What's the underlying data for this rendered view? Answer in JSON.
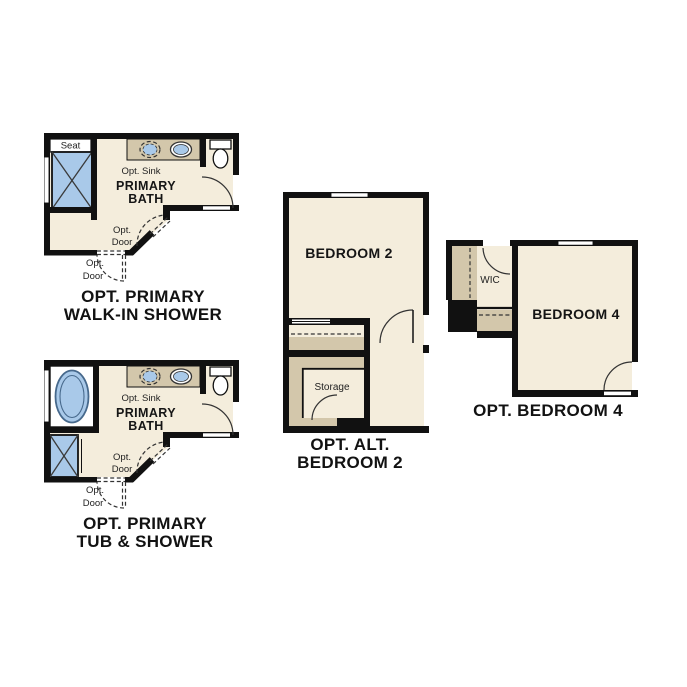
{
  "background": "#ffffff",
  "colors": {
    "wall": "#111111",
    "floor": "#f4eddc",
    "cabinet_tan": "#d3c7ab",
    "fixture_blue": "#a9c9e9",
    "text": "#121212"
  },
  "plans": {
    "walk_in_shower": {
      "caption": [
        "OPT. PRIMARY",
        "WALK-IN SHOWER"
      ],
      "room_label": [
        "PRIMARY",
        "BATH"
      ],
      "seat_label": "Seat",
      "opt_sink_label": "Opt. Sink",
      "opt_door_inner_label": [
        "Opt.",
        "Door"
      ],
      "opt_door_outer_label": [
        "Opt.",
        "Door"
      ]
    },
    "tub_shower": {
      "caption": [
        "OPT. PRIMARY",
        "TUB & SHOWER"
      ],
      "room_label": [
        "PRIMARY",
        "BATH"
      ],
      "opt_sink_label": "Opt. Sink",
      "opt_door_inner_label": [
        "Opt.",
        "Door"
      ],
      "opt_door_outer_label": [
        "Opt.",
        "Door"
      ]
    },
    "alt_bedroom2": {
      "caption": [
        "OPT. ALT.",
        "BEDROOM 2"
      ],
      "room_label": "BEDROOM 2",
      "storage_label": "Storage"
    },
    "bedroom4": {
      "caption": [
        "OPT. BEDROOM 4"
      ],
      "room_label": "BEDROOM 4",
      "wic_label": "WIC"
    }
  }
}
